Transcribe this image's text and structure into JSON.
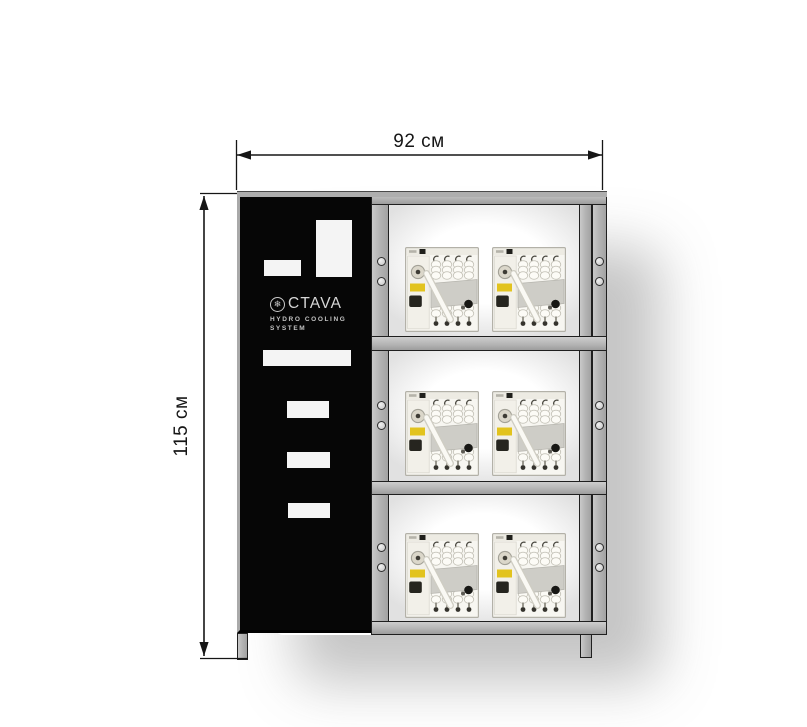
{
  "diagram": {
    "width_label": "92 см",
    "height_label": "115 см"
  },
  "cabinet": {
    "brand": {
      "logo_icon": "snowflake-icon",
      "logo_icon_glyph": "❄",
      "logo_text": "CTAVA",
      "subtitle_line1": "HYDRO COOLING",
      "subtitle_line2": "SYSTEM"
    },
    "rack": {
      "shelf_count": 3,
      "machines_per_shelf": 2
    }
  },
  "colors": {
    "frame_gray": "#b5b5b5",
    "frame_edge": "#1f1f1f",
    "panel_black": "#060606",
    "cutout_white": "#f4f4f4",
    "logo_gray": "#d4d4d4",
    "label_yellow": "#e2c31e",
    "dimension_black": "#161616"
  }
}
